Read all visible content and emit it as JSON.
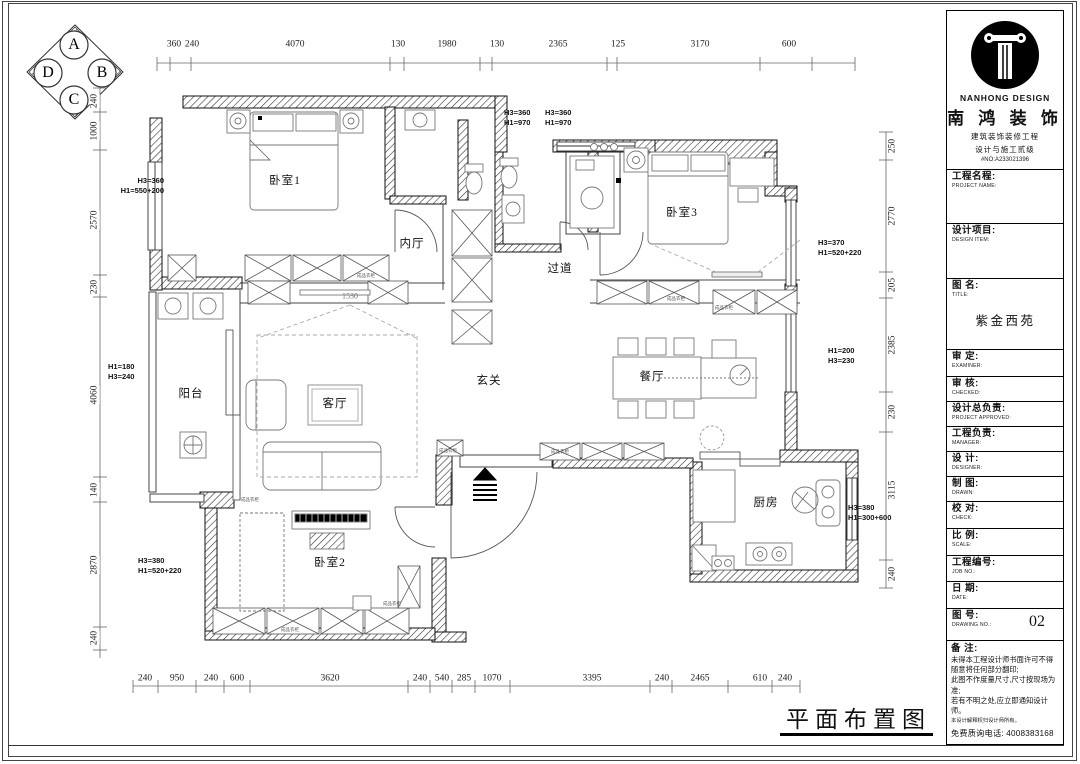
{
  "drawing_title": "平面布置图",
  "compass": {
    "top": "A",
    "right": "B",
    "bottom": "C",
    "left": "D"
  },
  "dims": {
    "top": [
      "360",
      "240",
      "4070",
      "130",
      "1980",
      "130",
      "2365",
      "125",
      "3170",
      "600"
    ],
    "bottom": [
      "240",
      "950",
      "240",
      "600",
      "3620",
      "240",
      "540",
      "285",
      "1070",
      "3395",
      "240",
      "2465",
      "610",
      "240"
    ],
    "left": [
      "240",
      "1000",
      "2570",
      "230",
      "4060",
      "140",
      "2870",
      "240"
    ],
    "right": [
      "250",
      "2770",
      "205",
      "2385",
      "230",
      "3115",
      "240"
    ]
  },
  "rooms": {
    "bedroom1": "卧室1",
    "bedroom2": "卧室2",
    "bedroom3": "卧室3",
    "inner_hall": "内厅",
    "corridor": "过道",
    "balcony": "阳台",
    "living": "客厅",
    "entry": "玄关",
    "dining": "餐厅",
    "kitchen": "厨房"
  },
  "annotations": {
    "top_mid_1": [
      "H3=360",
      "H1=970"
    ],
    "top_mid_2": [
      "H3=360",
      "H1=970"
    ],
    "left_upper": [
      "H3=360",
      "H1=550+200"
    ],
    "left_mid": [
      "H1=180",
      "H3=240"
    ],
    "left_lower": [
      "H3=380",
      "H1=520+220"
    ],
    "right_upper": [
      "H3=370",
      "H1=520+220"
    ],
    "right_mid": [
      "H1=200",
      "H3=230"
    ],
    "right_lower": [
      "H3=380",
      "H1=300+600"
    ],
    "living_width": "1530"
  },
  "furniture_labels": {
    "wardrobe": "成品衣柜"
  },
  "title_block": {
    "brand_en": "NANHONG DESIGN",
    "brand_cn": "南 鸿 装 饰",
    "brand_line1": "建筑装饰装修工程",
    "brand_line2": "设计与施工贰级",
    "brand_no": "#NO:A233021396",
    "fields": [
      {
        "cn": "工程名程:",
        "en": "PROJECT NAME:"
      },
      {
        "cn": "设计项目:",
        "en": "DESIGN ITEM:"
      },
      {
        "cn": "图  名:",
        "en": "TITLE:",
        "value": "紫金西苑"
      },
      {
        "cn": "审   定:",
        "en": "EXAMINER:"
      },
      {
        "cn": "审   核:",
        "en": "CHECKED:"
      },
      {
        "cn": "设计总负责:",
        "en": "PROJECT APPROVED:"
      },
      {
        "cn": "工程负责:",
        "en": "MANAGER:"
      },
      {
        "cn": "设   计:",
        "en": "DESIGNER:"
      },
      {
        "cn": "制   图:",
        "en": "DRAWN:"
      },
      {
        "cn": "校   对:",
        "en": "CHECK:"
      },
      {
        "cn": "比   例:",
        "en": "SCALE:"
      },
      {
        "cn": "工程编号:",
        "en": "JOB NO.:"
      },
      {
        "cn": "日   期:",
        "en": "DATE:"
      },
      {
        "cn": "图   号:",
        "en": "DRAWING NO.:",
        "value": "02"
      }
    ],
    "notes_title": "备  注:",
    "notes": [
      "未得本工程设计师书面许可不得随意将任何部分翻印;",
      "此图不作度量尺寸,尺寸按现场为准;",
      "若有不明之处,应立即通知设计师。"
    ],
    "fine_print": "本设计解释权归设计师所有。",
    "phone": "免费质询电话: 4008383168"
  }
}
